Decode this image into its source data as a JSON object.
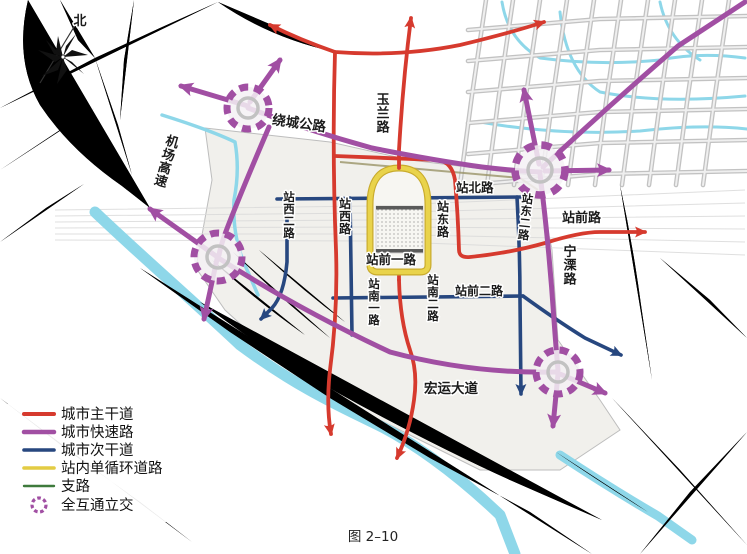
{
  "compass": {
    "north_label": "北"
  },
  "roads": {
    "raocheng": "绕城公路",
    "yulan": "玉兰路",
    "jichang": "机场高速",
    "zhanbei": "站北路",
    "zhanxi2": "站西二路",
    "zhanxi": "站西路",
    "zhandong": "站东路",
    "zhandong2": "站东二路",
    "zhanqian": "站前路",
    "ningli": "宁溧路",
    "zhanqian1": "站前一路",
    "zhanqian2": "站前二路",
    "zhannan1": "站南一路",
    "zhannan2": "站南二路",
    "hongyun": "宏运大道"
  },
  "legend": {
    "items": [
      {
        "label": "城市主干道",
        "color": "#d63a2e",
        "type": "line"
      },
      {
        "label": "城市快速路",
        "color": "#a14fa3",
        "type": "line"
      },
      {
        "label": "城市次干道",
        "color": "#27477f",
        "type": "line"
      },
      {
        "label": "站内单循环道路",
        "color": "#e3cc43",
        "type": "line"
      },
      {
        "label": "支路",
        "color": "#3e7a3c",
        "type": "line"
      },
      {
        "label": "全互通立交",
        "color": "#a14fa3",
        "type": "interchange-circle"
      }
    ]
  },
  "caption": "图 2–10",
  "colors": {
    "main_road": "#d63a2e",
    "expressway": "#a14fa3",
    "secondary": "#27477f",
    "station_loop": "#e3cc43",
    "branch": "#3e7a3c",
    "river": "#8ed7e9",
    "area_fill": "#f1f0ec"
  }
}
